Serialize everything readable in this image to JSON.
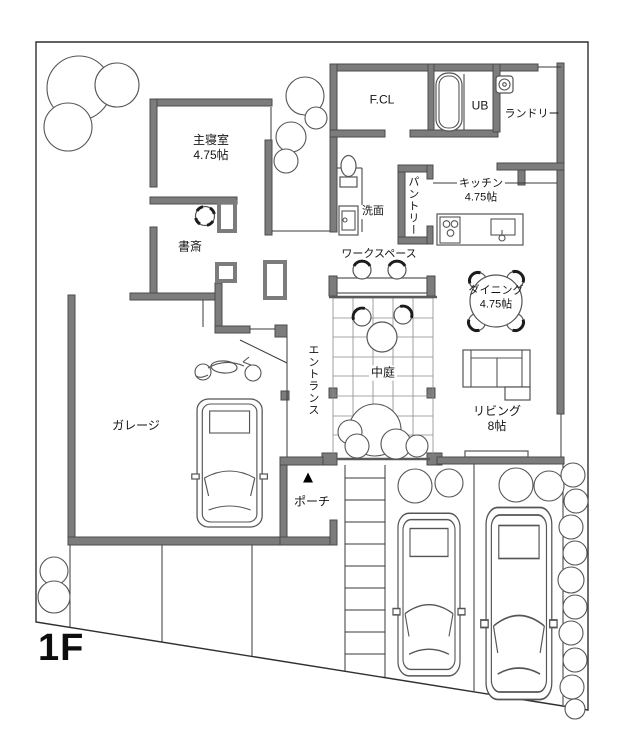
{
  "floor_label": "1F",
  "rooms": {
    "fcl": {
      "label": "F.CL"
    },
    "ub": {
      "label": "UB"
    },
    "laundry": {
      "label": "ランドリー"
    },
    "master_bedroom": {
      "label": "主寝室",
      "size": "4.75帖"
    },
    "study": {
      "label": "書斎"
    },
    "washroom": {
      "label": "洗面"
    },
    "pantry": {
      "label": "パントリー"
    },
    "kitchen": {
      "label": "キッチン",
      "size": "4.75帖"
    },
    "workspace": {
      "label": "ワークスペース"
    },
    "courtyard": {
      "label": "中庭"
    },
    "dining": {
      "label": "ダイニング",
      "size": "4.75帖"
    },
    "living": {
      "label": "リビング",
      "size": "8帖"
    },
    "entrance": {
      "label": "エントランス"
    },
    "garage": {
      "label": "ガレージ"
    },
    "porch": {
      "label": "ポーチ",
      "arrow": "▲"
    }
  },
  "icons": {
    "bathtub": "bathtub-icon",
    "washer": "washing-machine-icon",
    "toilet": "toilet-icon",
    "washbasin": "washbasin-icon",
    "stove": "stove-icon",
    "kitchen_sink": "kitchen-sink-icon",
    "dining_table": "dining-table-icon",
    "round_table": "round-table-icon",
    "chair": "chair-icon",
    "desk": "desk-icon",
    "sofa": "sofa-icon",
    "car": "car-icon",
    "motorcycle": "motorcycle-icon",
    "tree": "tree-icon",
    "entrance_arrow": "entrance-arrow-icon"
  },
  "colors": {
    "wall_fill": "#7c7c7c",
    "wall_outline": "#4b4b4b",
    "line": "#3a3a3a",
    "text": "#141414",
    "background": "#ffffff",
    "chair_back": "#1c1c1c"
  }
}
